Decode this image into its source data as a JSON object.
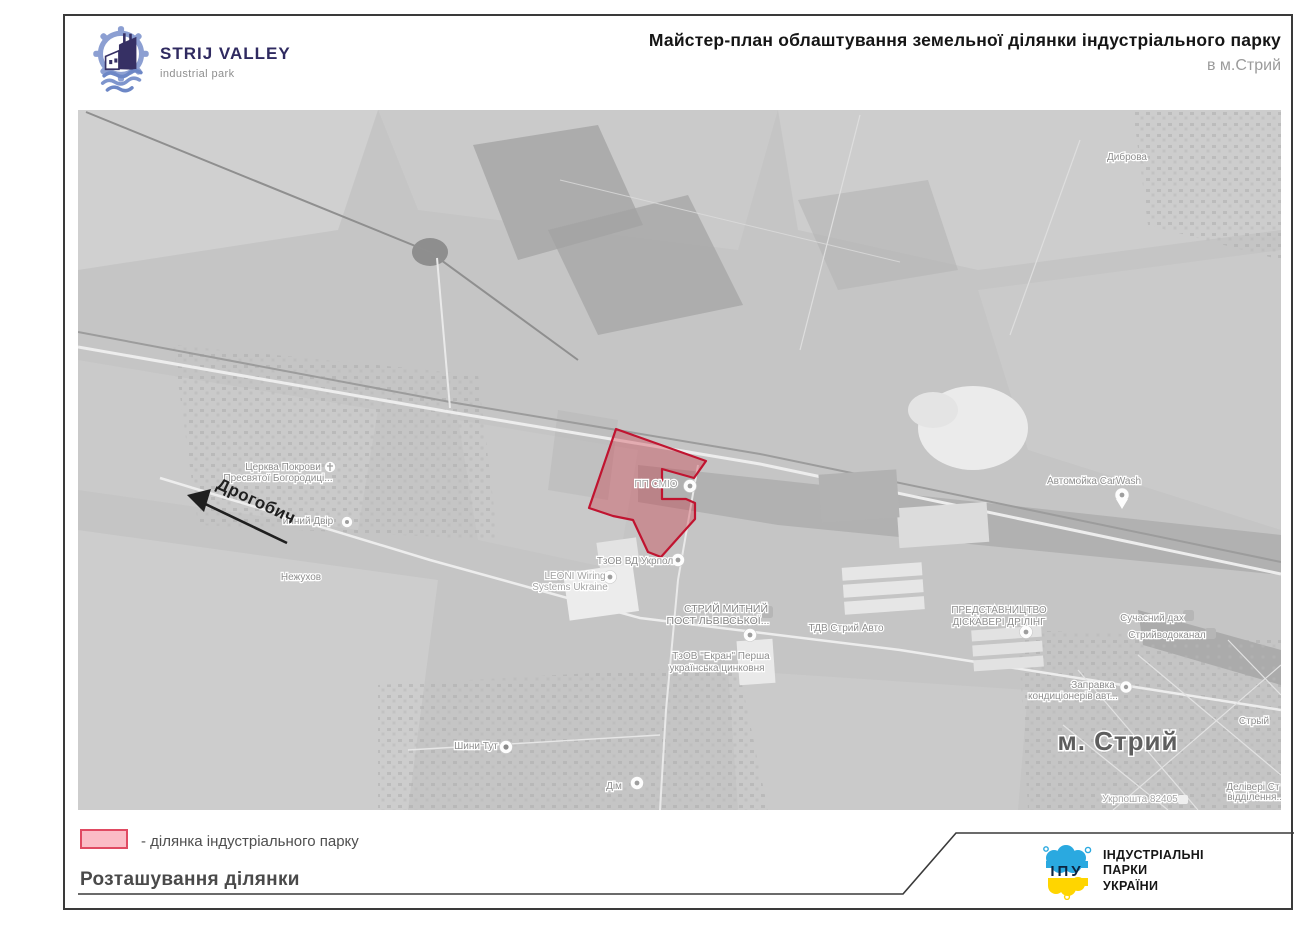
{
  "header": {
    "logo": {
      "title": "STRIJ VALLEY",
      "subtitle": "industrial park"
    },
    "title": "Майстер-план облаштування земельної ділянки індустріального парку",
    "subtitle": "в м.Стрий"
  },
  "map": {
    "labels": [
      {
        "text": "Диброва"
      },
      {
        "text": "Церква Покрови"
      },
      {
        "text": "Пресвятої Богородиці..."
      },
      {
        "text": "инний Двір"
      },
      {
        "text": "Нежухов"
      },
      {
        "text": "Дрогобич"
      },
      {
        "text": "ПП СМІО"
      },
      {
        "text": "ТзОВ ВД Укрпол"
      },
      {
        "text": "LEONI Wiring"
      },
      {
        "text": "Systems Ukraine"
      },
      {
        "text": "СТРИЙ МИТНИЙ"
      },
      {
        "text": "ПОСТ ЛЬВІВСЬКОЇ..."
      },
      {
        "text": "ТДВ Стрий Авто"
      },
      {
        "text": "ТзОВ \"Екран\" Перша"
      },
      {
        "text": "українська цинковня"
      },
      {
        "text": "ПРЕДСТАВНИЦТВО"
      },
      {
        "text": "ДІСКАВЕРІ ДРІЛІНГ"
      },
      {
        "text": "Сучасний дах"
      },
      {
        "text": "Стрийводоканал"
      },
      {
        "text": "Заправка"
      },
      {
        "text": "кондиціонерів авт..."
      },
      {
        "text": "Автомойка CarWash"
      },
      {
        "text": "м. Стрий"
      },
      {
        "text": "Стрый"
      },
      {
        "text": "Делівері Ст"
      },
      {
        "text": "відділення..."
      },
      {
        "text": "Укрпошта 82405"
      },
      {
        "text": "Шини Тут"
      },
      {
        "text": "Дім"
      }
    ]
  },
  "legend": {
    "swatch_label": "- ділянка індустріального парку"
  },
  "footer": {
    "caption": "Розташування ділянки"
  },
  "org": {
    "abbr": "ІПУ",
    "line1": "ІНДУСТРІАЛЬНІ",
    "line2": "ПАРКИ",
    "line3": "УКРАЇНИ"
  },
  "colors": {
    "site_fill": "#fbbcc6",
    "site_border": "#c01430",
    "brand_navy": "#2f2a60",
    "brand_blue": "#8c9fd2",
    "org_blue": "#2aa9e0",
    "org_yellow": "#ffd500"
  }
}
